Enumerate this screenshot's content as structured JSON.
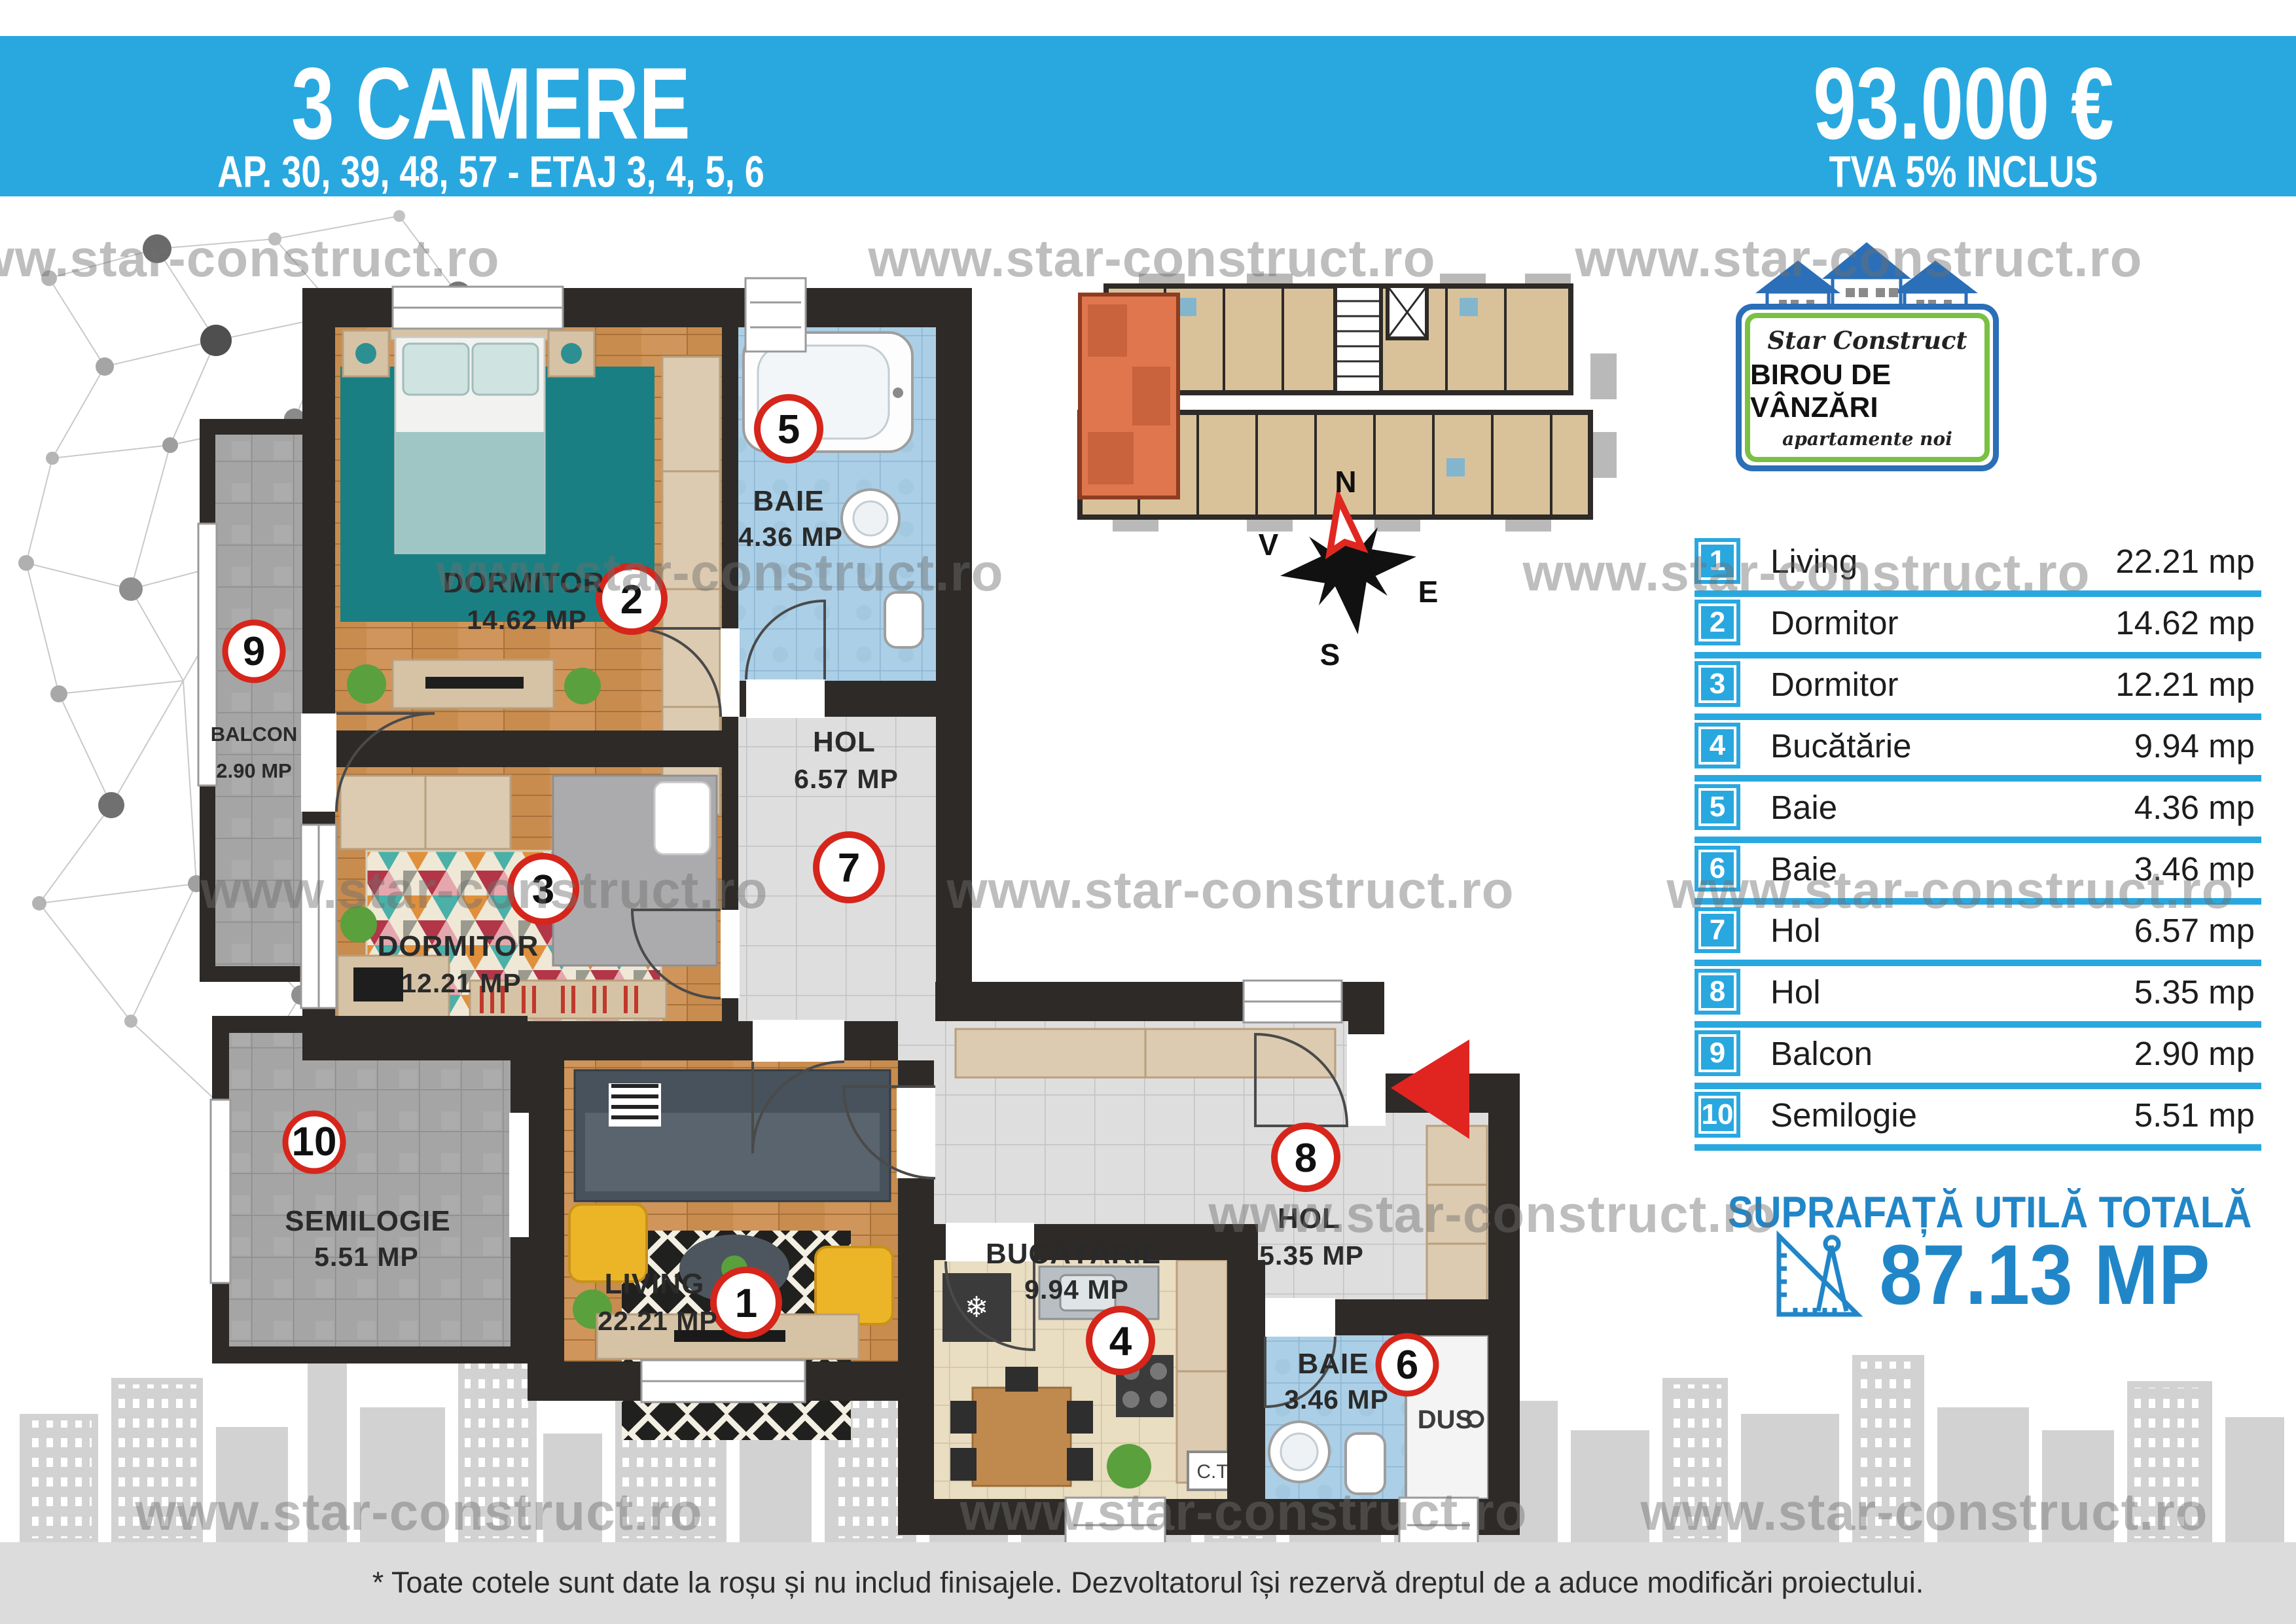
{
  "banner": {
    "title": "3 CAMERE",
    "subtitle": "AP. 30, 39, 48, 57 - ETAJ 3, 4, 5, 6",
    "price": "93.000 €",
    "vat_note": "TVA 5% INCLUS"
  },
  "logo": {
    "brand": "Star Construct",
    "line2": "BIROU DE VÂNZĂRI",
    "line3": "apartamente noi"
  },
  "compass": {
    "n": "N",
    "e": "E",
    "s": "S",
    "v": "V"
  },
  "rooms": [
    {
      "num": "1",
      "label": "Living",
      "area": "22.21 mp",
      "plan_name": "LIVING",
      "plan_area": "22.21 MP"
    },
    {
      "num": "2",
      "label": "Dormitor",
      "area": "14.62 mp",
      "plan_name": "DORMITOR",
      "plan_area": "14.62 MP"
    },
    {
      "num": "3",
      "label": "Dormitor",
      "area": "12.21 mp",
      "plan_name": "DORMITOR",
      "plan_area": "12.21 MP"
    },
    {
      "num": "4",
      "label": "Bucătărie",
      "area": "9.94 mp",
      "plan_name": "BUCĂTĂRIE",
      "plan_area": "9.94 MP"
    },
    {
      "num": "5",
      "label": "Baie",
      "area": "4.36 mp",
      "plan_name": "BAIE",
      "plan_area": "4.36 MP"
    },
    {
      "num": "6",
      "label": "Baie",
      "area": "3.46 mp",
      "plan_name": "BAIE",
      "plan_area": "3.46 MP"
    },
    {
      "num": "7",
      "label": "Hol",
      "area": "6.57 mp",
      "plan_name": "HOL",
      "plan_area": "6.57 MP"
    },
    {
      "num": "8",
      "label": "Hol",
      "area": "5.35 mp",
      "plan_name": "HOL",
      "plan_area": "5.35 MP"
    },
    {
      "num": "9",
      "label": "Balcon",
      "area": "2.90 mp",
      "plan_name": "BALCON",
      "plan_area": "2.90 MP"
    },
    {
      "num": "10",
      "label": "Semilogie",
      "area": "5.51 mp",
      "plan_name": "SEMILOGIE",
      "plan_area": "5.51 MP"
    }
  ],
  "total": {
    "label": "SUPRAFAȚĂ UTILĂ TOTALĂ",
    "value": "87.13 MP"
  },
  "extras": {
    "ct": "C.T.",
    "dus": "DUS"
  },
  "watermark": {
    "text": "www.star-construct.ro"
  },
  "footer": {
    "note": "* Toate cotele sunt date la roșu și nu includ finisajele. Dezvoltatorul își rezervă dreptul de a aduce modificări proiectului."
  }
}
